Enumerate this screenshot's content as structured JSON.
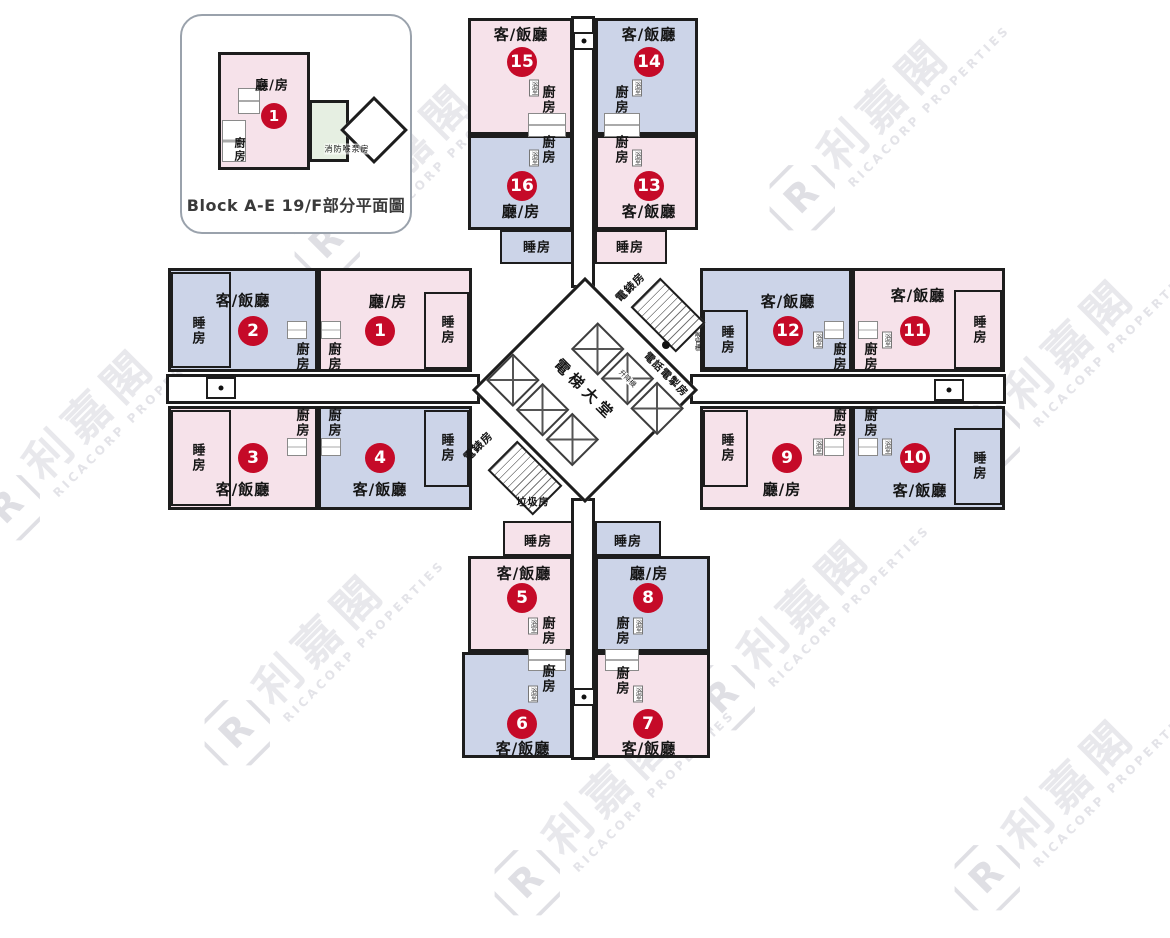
{
  "inset": {
    "caption": "Block A-E 19/F部分平面圖",
    "unit_number": "1",
    "living_room": "廳/房",
    "kitchen": "廚房",
    "fire_pump_room": "消防喉泵房"
  },
  "core": {
    "lift_lobby": "電梯大堂",
    "lift": "升降機",
    "meter_room_top": "電錶房",
    "meter_room_bottom": "電錶房",
    "tel_switch_room": "電話電掣房",
    "refuse_room": "垃圾房",
    "pipe_duct": "喉管槽"
  },
  "watermark": {
    "cn": "利嘉閣",
    "en": "RICACORP PROPERTIES",
    "logo_letter": "R"
  },
  "colors": {
    "pink": "#f6e2ea",
    "blue": "#ccd4e8",
    "green": "#e6efe2",
    "red": "#c50a28",
    "wall": "#1d1d1d"
  },
  "units": [
    {
      "number": "15",
      "living": "客/飯廳",
      "kitchen": "廚房",
      "bath": "浴室"
    },
    {
      "number": "14",
      "living": "客/飯廳",
      "kitchen": "廚房",
      "bath": "浴室"
    },
    {
      "number": "16",
      "living": "廳/房",
      "kitchen": "廚房",
      "bedroom": "睡房",
      "bath": "浴室"
    },
    {
      "number": "13",
      "living": "客/飯廳",
      "kitchen": "廚房",
      "bedroom": "睡房",
      "bath": "浴室"
    },
    {
      "number": "2",
      "living": "客/飯廳",
      "kitchen": "廚房",
      "bedroom": "睡房"
    },
    {
      "number": "1",
      "living": "廳/房",
      "kitchen": "廚房",
      "bedroom": "睡房"
    },
    {
      "number": "3",
      "living": "客/飯廳",
      "kitchen": "廚房",
      "bedroom": "睡房"
    },
    {
      "number": "4",
      "living": "客/飯廳",
      "kitchen": "廚房",
      "bedroom": "睡房"
    },
    {
      "number": "12",
      "living": "客/飯廳",
      "kitchen": "廚房",
      "bedroom": "睡房",
      "bath": "浴室"
    },
    {
      "number": "11",
      "living": "客/飯廳",
      "kitchen": "廚房",
      "bedroom": "睡房",
      "bath": "浴室"
    },
    {
      "number": "9",
      "living": "廳/房",
      "kitchen": "廚房",
      "bedroom": "睡房",
      "bath": "浴室"
    },
    {
      "number": "10",
      "living": "客/飯廳",
      "kitchen": "廚房",
      "bedroom": "睡房",
      "bath": "浴室"
    },
    {
      "number": "5",
      "living": "客/飯廳",
      "kitchen": "廚房",
      "bedroom": "睡房",
      "bath": "浴室"
    },
    {
      "number": "8",
      "living": "廳/房",
      "kitchen": "廚房",
      "bedroom": "睡房",
      "bath": "浴室"
    },
    {
      "number": "6",
      "living": "客/飯廳",
      "kitchen": "廚房",
      "bath": "浴室"
    },
    {
      "number": "7",
      "living": "客/飯廳",
      "kitchen": "廚房",
      "bath": "浴室"
    }
  ]
}
